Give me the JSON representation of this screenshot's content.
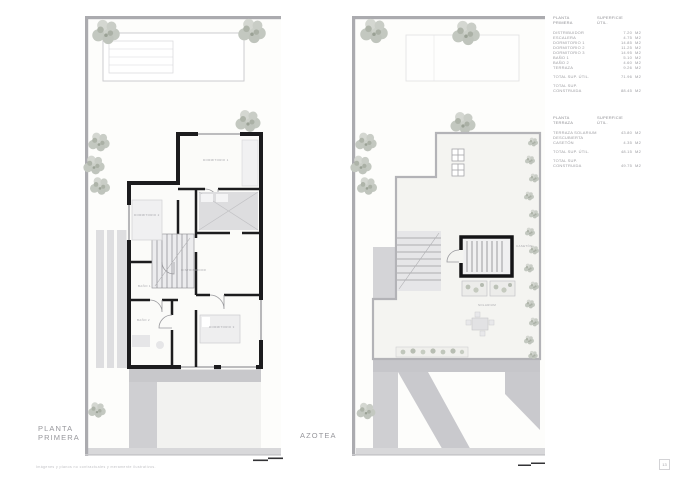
{
  "page": {
    "footer_disclaimer": "Imágenes y planos no contractuales y meramente ilustrativos.",
    "page_number": "13"
  },
  "plans": [
    {
      "label_line1": "PLANTA",
      "label_line2": "PRIMERA",
      "rooms": {
        "dormitorio1": "DORMITORIO 1",
        "dormitorio2": "DORMITORIO 2",
        "dormitorio3": "DORMITORIO 3",
        "banio1": "BAÑO 1",
        "banio2": "BAÑO 2",
        "distribuidor": "DISTRIBUIDOR"
      }
    },
    {
      "label_line1": "AZOTEA",
      "rooms": {
        "solarium": "SOLARIUM",
        "caseton": "CASETÓN"
      }
    }
  ],
  "tables": [
    {
      "header": {
        "col1_line1": "PLANTA",
        "col1_line2": "PRIMERA",
        "col2_line1": "SUPERFICIE",
        "col2_line2": "ÚTIL."
      },
      "rows": [
        {
          "label": "DISTRIBUIDOR",
          "value": "7.20",
          "unit": "M2"
        },
        {
          "label": "ESCALERA",
          "value": "4.75",
          "unit": "M2"
        },
        {
          "label": "DORMITORIO 1",
          "value": "14.85",
          "unit": "M2"
        },
        {
          "label": "DORMITORIO 2",
          "value": "11.25",
          "unit": "M2"
        },
        {
          "label": "DORMITORIO 3",
          "value": "14.95",
          "unit": "M2"
        },
        {
          "label": "BAÑO 1",
          "value": "5.10",
          "unit": "M2"
        },
        {
          "label": "BAÑO 2",
          "value": "4.60",
          "unit": "M2"
        },
        {
          "label": "TERRAZA",
          "value": "9.26",
          "unit": "M2"
        }
      ],
      "totals": [
        {
          "label_line1": "TOTAL SUP. ÚTIL.",
          "label_line2": "",
          "value": "71.96",
          "unit": "M2"
        },
        {
          "label_line1": "TOTAL SUP.",
          "label_line2": "CONSTRUIDA",
          "value": "88.45",
          "unit": "M2"
        }
      ]
    },
    {
      "header": {
        "col1_line1": "PLANTA",
        "col1_line2": "TERRAZA",
        "col2_line1": "SUPERFICIE",
        "col2_line2": "ÚTIL."
      },
      "rows": [
        {
          "label_line1": "TERRAZA SOLARIUM",
          "label_line2": "DESCUBIERTA",
          "value": "43.80",
          "unit": "M2"
        },
        {
          "label_line1": "CASETÓN",
          "label_line2": "",
          "value": "4.35",
          "unit": "M2"
        }
      ],
      "totals": [
        {
          "label_line1": "TOTAL SUP. ÚTIL.",
          "label_line2": "",
          "value": "48.15",
          "unit": "M2"
        },
        {
          "label_line1": "TOTAL SUP.",
          "label_line2": "CONSTRUIDA",
          "value": "49.75",
          "unit": "M2"
        }
      ]
    }
  ],
  "colors": {
    "wall": "#1c1c1e",
    "boundary": "#ababaf",
    "shadow": "#c9c9cd",
    "foliage": "#c6cac2",
    "table_text": "#9c9ca1"
  }
}
